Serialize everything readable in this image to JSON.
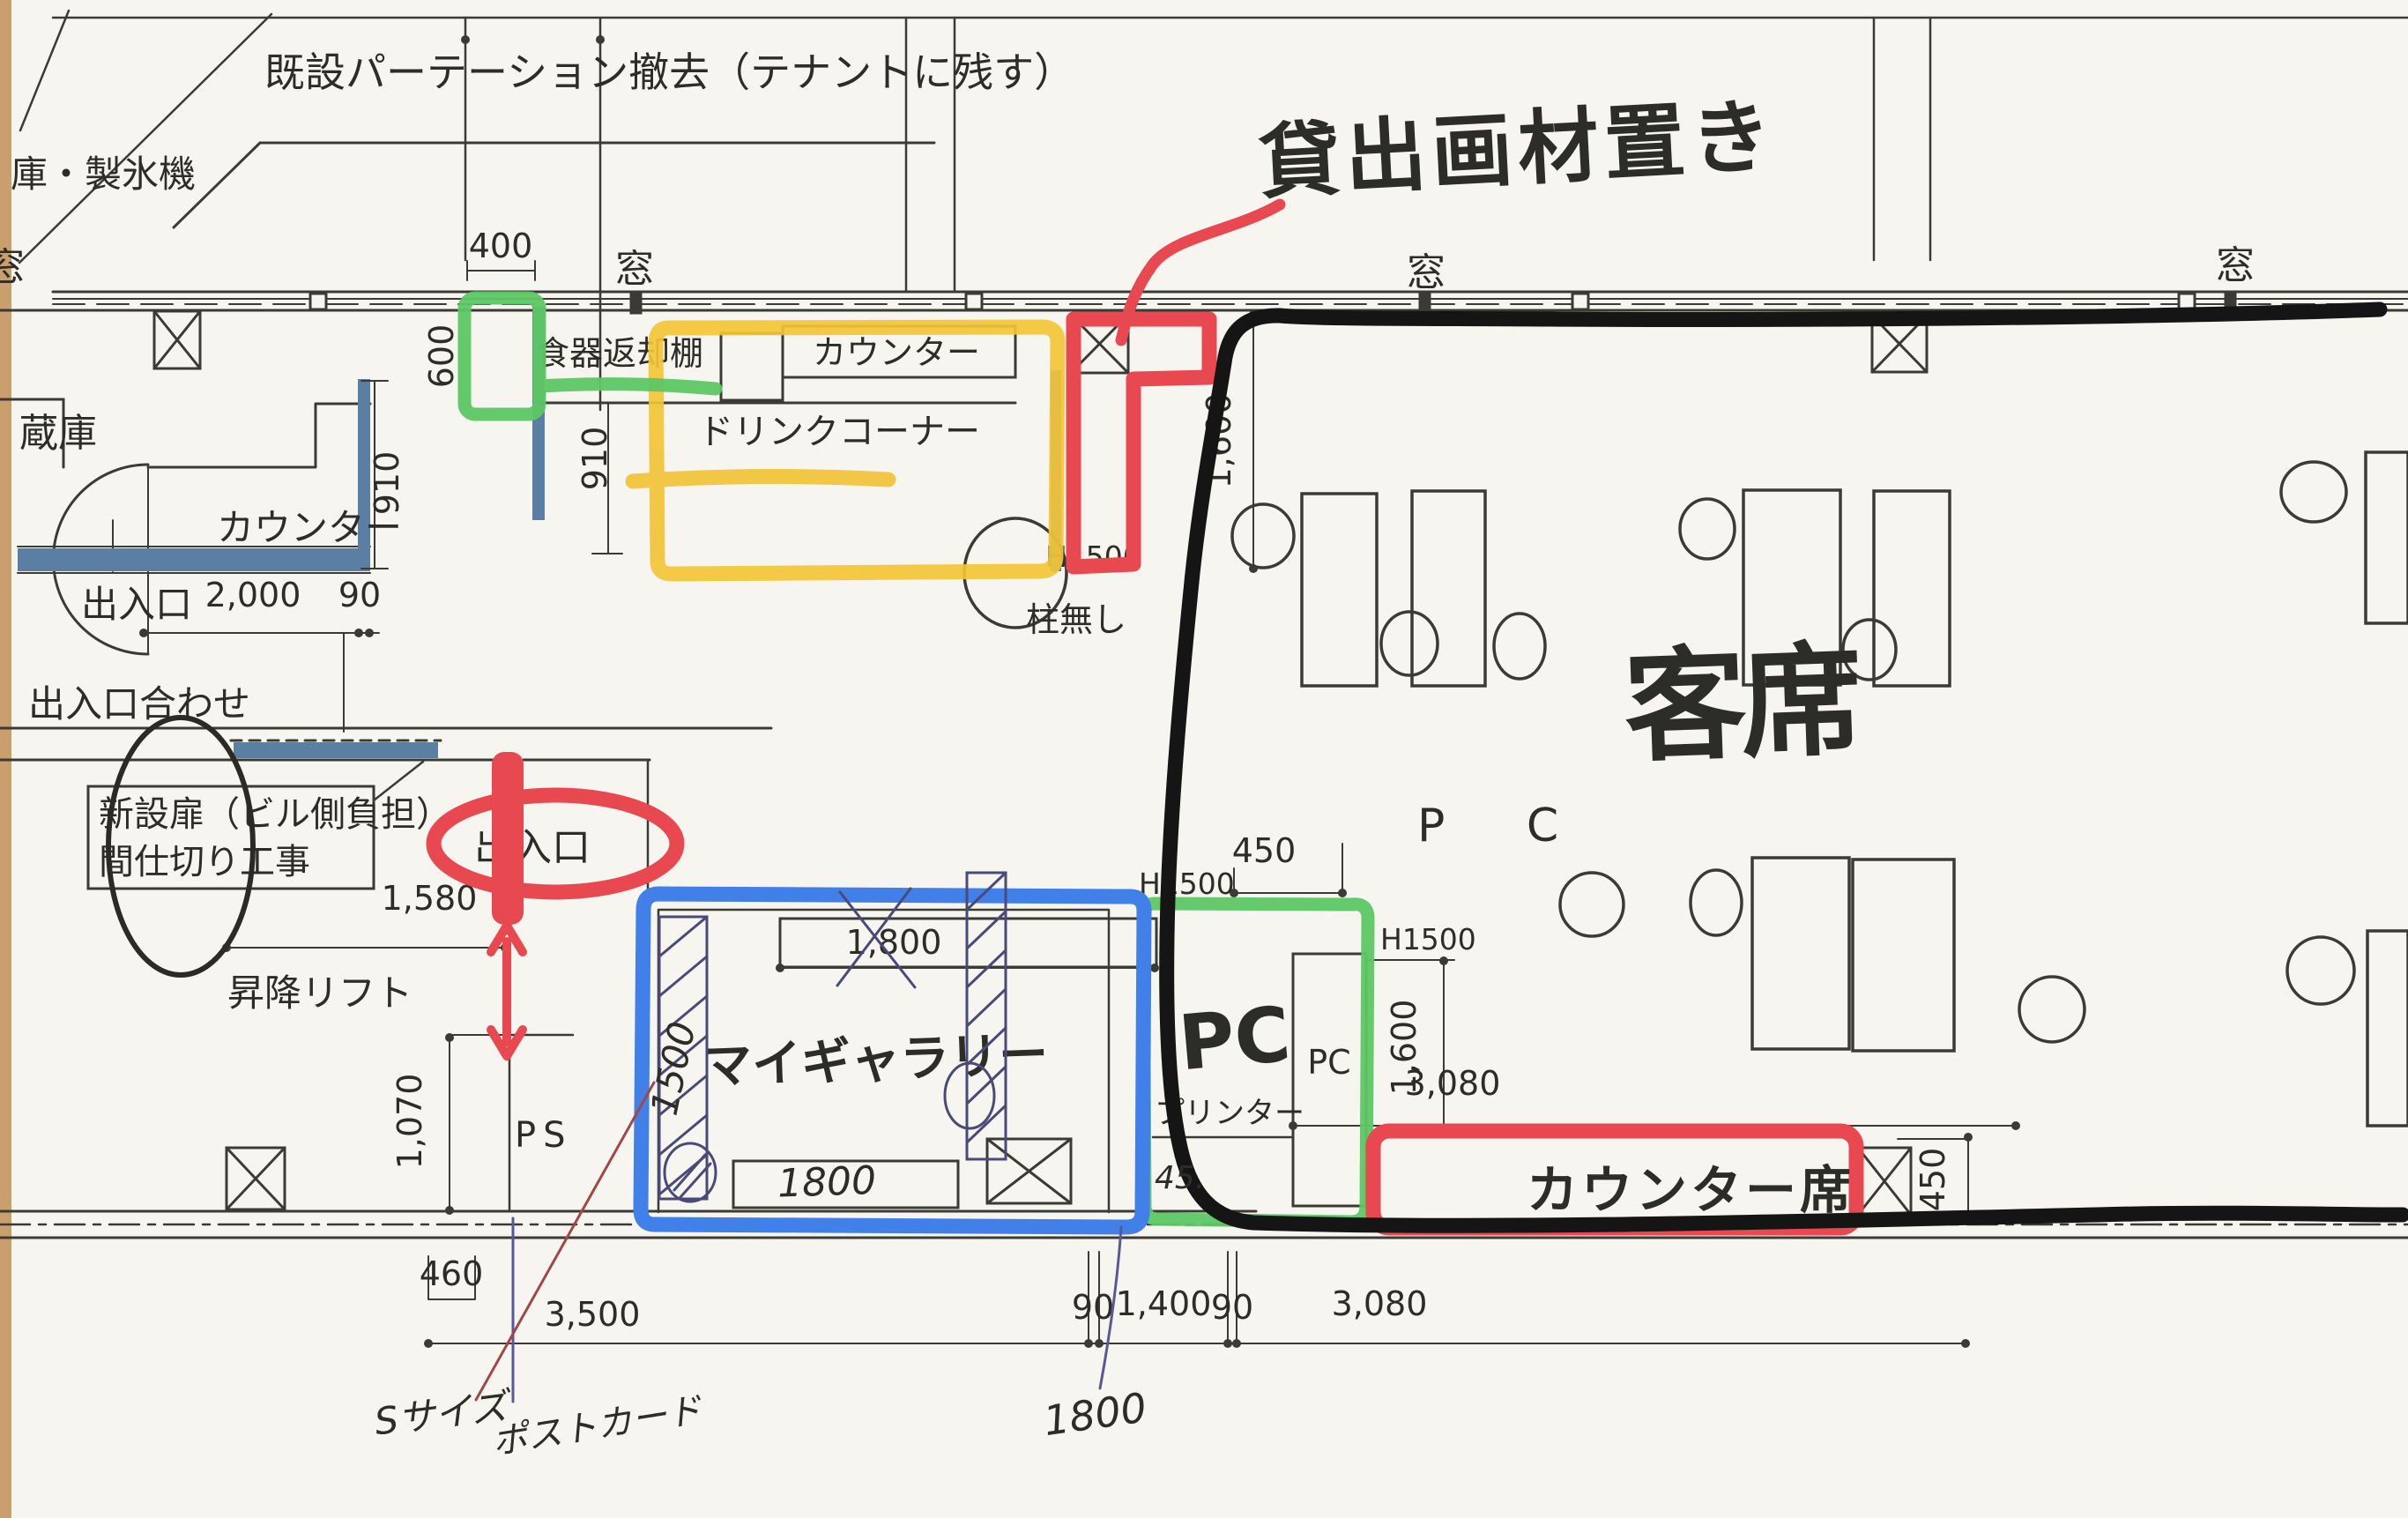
{
  "document": {
    "kind": "scanned-floor-plan-photo",
    "language": "ja",
    "description": "Tenant cafe/gallery floor plan with handwritten marker annotations"
  },
  "colors": {
    "paper": "#f7f5f0",
    "paper_edge": "#c99f6b",
    "print_line": "#3b3b36",
    "wall_blue": "#5b7fa3",
    "marker_yellow": "#f2c437",
    "marker_green": "#5dc764",
    "marker_red": "#e8484f",
    "marker_blue": "#4080e8",
    "marker_black": "#151515",
    "pen_ink": "#4a4a78",
    "pen_darkred": "#a04848",
    "pen_purple": "#5a5796"
  },
  "printed": {
    "partition_note": "既設パーテーション撤去（テナントに残す）",
    "ice_machine": "庫・製氷機",
    "window": "窓",
    "dish_return_shelf": "食器返却棚",
    "counter": "カウンター",
    "drink_corner": "ドリンクコーナー",
    "storage": "蔵庫",
    "entrance": "出入口",
    "entrance_align": "出入口合わせ",
    "new_door_line1": "新設扉（ビル側負担）",
    "new_door_line2": "間仕切り工事",
    "lift": "昇降リフト",
    "no_pillar": "柱無し",
    "h1500": "H1500",
    "pc_area": "P C",
    "pc_box": "PC",
    "printer": "プリンター",
    "ps": "PS"
  },
  "dims": {
    "w400": "400",
    "w600": "600",
    "w910": "910",
    "w2000": "2,000",
    "w90": "90",
    "w1600": "1,600",
    "w1580": "1,580",
    "w1070": "1,070",
    "w1800": "1,800",
    "w450": "450",
    "w3080": "3,080",
    "w460": "460",
    "w3500": "3,500",
    "w1400": "1,400"
  },
  "handwritten": {
    "rental_art_supplies": "貸出画材置き",
    "guest_seats": "客席",
    "my_gallery": "マイギャラリー",
    "pc": "PC",
    "counter_seats": "カウンター席",
    "s_size": "Sサイズ",
    "postcard": "ポストカード",
    "n1500": "1500",
    "n1800": "1800",
    "n45": "45."
  }
}
